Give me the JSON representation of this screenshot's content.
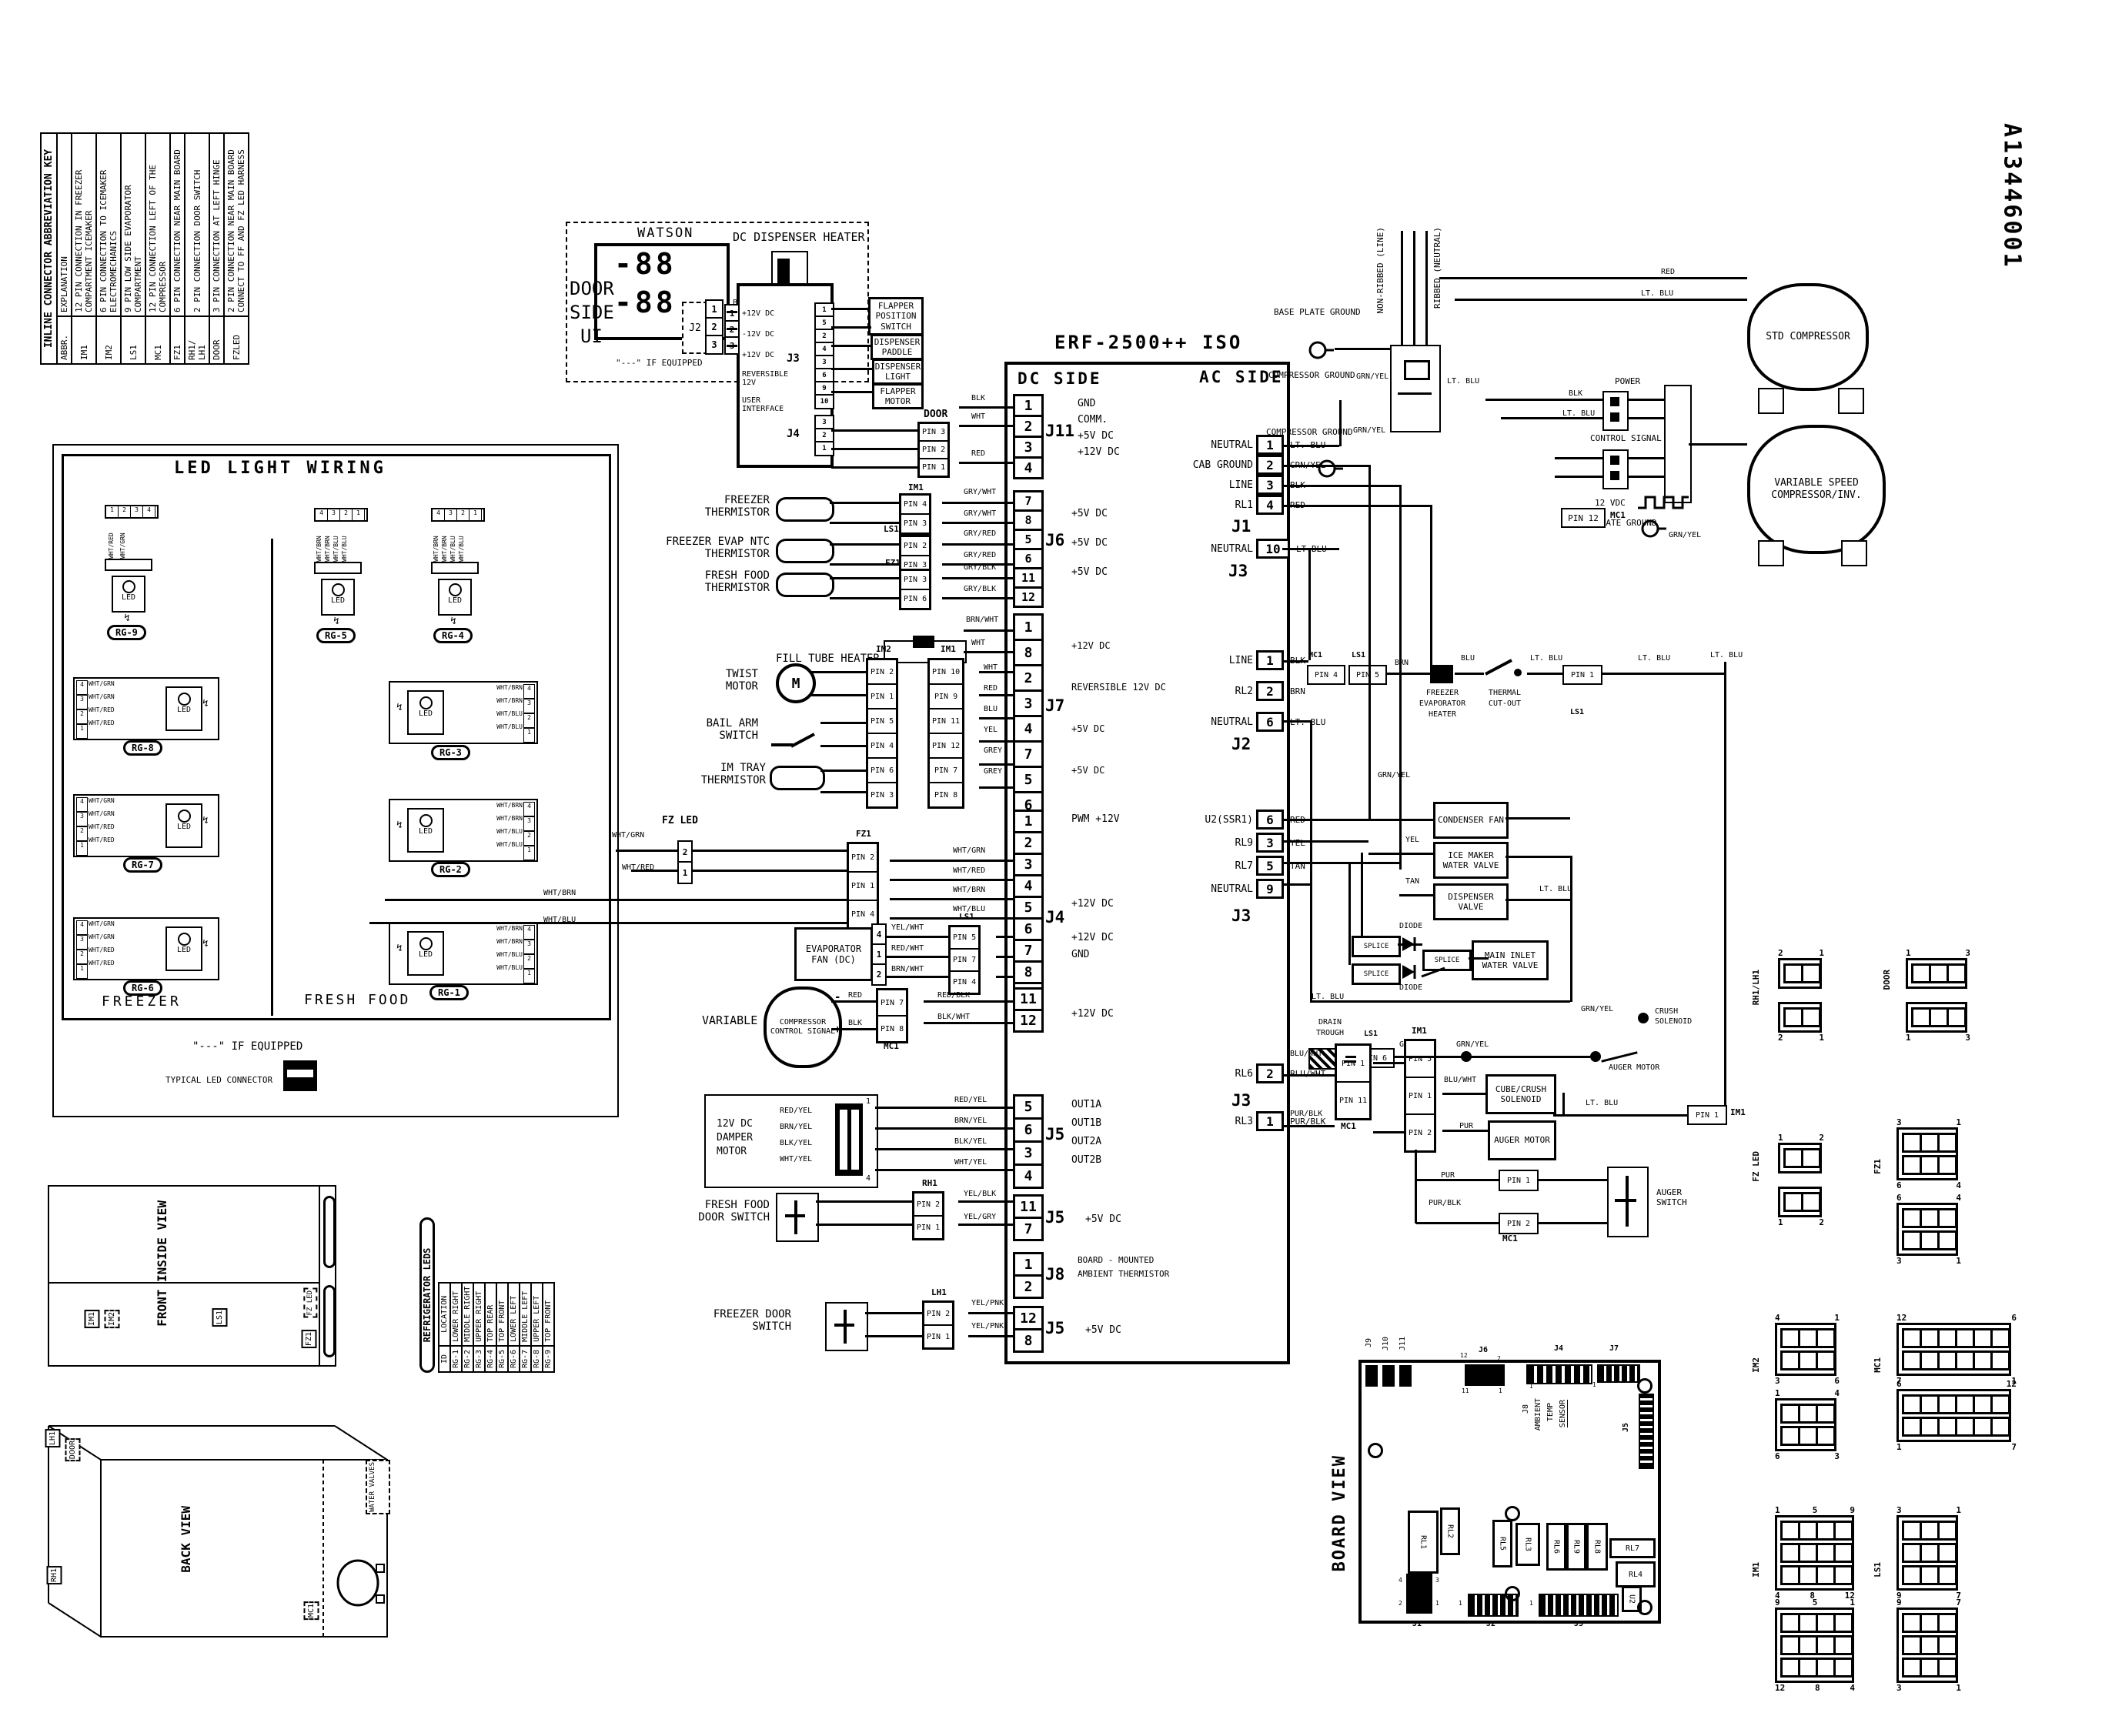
{
  "doc_number": "A13446001",
  "titles": {
    "board": "ERF-2500++ ISO",
    "dc": "DC SIDE",
    "ac": "AC SIDE",
    "led_box": "LED LIGHT WIRING",
    "freezer": "FREEZER",
    "fresh_food": "FRESH FOOD",
    "if_equipped": "\"---\" IF EQUIPPED",
    "typical_led": "TYPICAL LED CONNECTOR",
    "board_view": "BOARD VIEW",
    "front_view": "FRONT INSIDE VIEW",
    "back_view": "BACK VIEW"
  },
  "abbr_key": {
    "title": "INLINE CONNECTOR ABBREVIATION KEY",
    "headers": [
      "ABBR.",
      "EXPLANATION"
    ],
    "rows": [
      [
        "IM1",
        "12 PIN CONNECTION IN FREEZER COMPARTMENT ICEMAKER"
      ],
      [
        "IM2",
        "6 PIN CONNECTION TO ICEMAKER ELECTROMECHANICS"
      ],
      [
        "LS1",
        "9 PIN LOW SIDE EVAPORATOR COMPARTMENT"
      ],
      [
        "MC1",
        "12 PIN CONNECTION LEFT OF THE COMPRESSOR"
      ],
      [
        "FZ1",
        "6 PIN CONNECTION NEAR MAIN BOARD"
      ],
      [
        "RH1/ LH1",
        "2 PIN CONNECTION DOOR SWITCH"
      ],
      [
        "DOOR",
        "3 PIN CONNECTION AT LEFT HINGE"
      ],
      [
        "FZLED",
        "2 PIN CONNECTION NEAR MAIN BOARD CONNECT TO FF AND FZ LED HARNESS"
      ]
    ]
  },
  "led_table": {
    "title": "REFRIGERATOR LEDS",
    "headers": [
      "ID",
      "LOCATION"
    ],
    "rows": [
      [
        "RG-1",
        "LOWER RIGHT"
      ],
      [
        "RG-2",
        "MIDDLE RIGHT"
      ],
      [
        "RG-3",
        "UPPER RIGHT"
      ],
      [
        "RG-4",
        "TOP REAR"
      ],
      [
        "RG-5",
        "TOP FRONT"
      ],
      [
        "RG-6",
        "LOWER LEFT"
      ],
      [
        "RG-7",
        "MIDDLE LEFT"
      ],
      [
        "RG-8",
        "UPPER LEFT"
      ],
      [
        "RG-9",
        "TOP FRONT"
      ]
    ]
  },
  "led_glyph": {
    "led": "LED",
    "zap": "↯"
  },
  "led_groups": {
    "rg9": {
      "id": "RG-9",
      "pins": [
        "1",
        "2",
        "3",
        "4"
      ],
      "wires": [
        "WHT/RED",
        "WHT/GRN"
      ]
    },
    "rg5": {
      "id": "RG-5",
      "pins": [
        "4",
        "3",
        "2",
        "1"
      ],
      "wires": [
        "WHT/BRN",
        "WHT/BRN",
        "WHT/BLU",
        "WHT/BLU"
      ]
    },
    "rg4": {
      "id": "RG-4",
      "pins": [
        "4",
        "3",
        "2",
        "1"
      ],
      "wires": [
        "WHT/BRN",
        "WHT/BRN",
        "WHT/BLU",
        "WHT/BLU"
      ]
    },
    "rg8": {
      "id": "RG-8",
      "pins": [
        "4",
        "3",
        "2",
        "1"
      ],
      "wires": [
        "WHT/GRN",
        "WHT/GRN",
        "WHT/RED",
        "WHT/RED"
      ]
    },
    "rg3": {
      "id": "RG-3",
      "pins": [
        "4",
        "3",
        "2",
        "1"
      ],
      "wires": [
        "WHT/BRN",
        "WHT/BRN",
        "WHT/BLU",
        "WHT/BLU"
      ]
    },
    "rg7": {
      "id": "RG-7",
      "pins": [
        "4",
        "3",
        "2",
        "1"
      ],
      "wires": [
        "WHT/GRN",
        "WHT/GRN",
        "WHT/RED",
        "WHT/RED"
      ]
    },
    "rg2": {
      "id": "RG-2",
      "pins": [
        "4",
        "3",
        "2",
        "1"
      ],
      "wires": [
        "WHT/BRN",
        "WHT/BRN",
        "WHT/BLU",
        "WHT/BLU"
      ]
    },
    "rg6": {
      "id": "RG-6",
      "pins": [
        "4",
        "3",
        "2",
        "1"
      ],
      "wires": [
        "WHT/GRN",
        "WHT/GRN",
        "WHT/RED",
        "WHT/RED"
      ]
    },
    "rg1": {
      "id": "RG-1",
      "pins": [
        "4",
        "3",
        "2",
        "1"
      ],
      "wires": [
        "WHT/BRN",
        "WHT/BRN",
        "WHT/BLU",
        "WHT/BLU"
      ]
    }
  },
  "watson": {
    "title": "WATSON",
    "side1": "DOOR",
    "side2": "SIDE",
    "side3": "UI",
    "digits": [
      "-88",
      "-88"
    ],
    "conn": "J2",
    "pins": [
      "1",
      "2",
      "3"
    ],
    "wires": [
      "BLK",
      "WHT",
      "RED"
    ],
    "note": "\"---\" IF EQUIPPED"
  },
  "ui_board": {
    "heater": "DC DISPENSER HEATER",
    "heater_conn": "J7",
    "heater_pins": [
      "1",
      "2",
      "1",
      "2"
    ],
    "fn": [
      "+12V DC",
      "-12V DC",
      "+12V DC",
      "REVERSIBLE 12V",
      "USER INTERFACE"
    ],
    "j3": "J3",
    "j3_pins": [
      "1",
      "5",
      "2",
      "4",
      "3",
      "6",
      "9",
      "10"
    ],
    "j4": "J4",
    "j4_pins": [
      "3",
      "2",
      "1"
    ],
    "in_pins": [
      "1",
      "2",
      "3"
    ],
    "loads": [
      "FLAPPER POSITION SWITCH",
      "DISPENSER PADDLE",
      "DISPENSER LIGHT",
      "FLAPPER MOTOR"
    ]
  },
  "door_link": {
    "name": "DOOR",
    "pins": [
      "PIN 3",
      "PIN 2",
      "PIN 1"
    ],
    "wires": [
      "BLK",
      "WHT",
      "RED"
    ]
  },
  "main_dc": {
    "j11": {
      "name": "J11",
      "pins": [
        "1",
        "2",
        "3",
        "4"
      ],
      "fn": [
        "GND",
        "COMM.",
        "+5V DC",
        "+12V DC"
      ]
    },
    "j6": {
      "name": "J6",
      "pins": [
        "7",
        "8",
        "5",
        "6",
        "11",
        "12"
      ],
      "fn": [
        "",
        "+5V DC",
        "",
        "+5V DC",
        "",
        "+5V DC"
      ]
    },
    "j7": {
      "name": "J7",
      "pins": [
        "1",
        "8",
        "2",
        "3",
        "4",
        "7",
        "5",
        "6"
      ],
      "fn": [
        "",
        "+12V DC",
        "",
        "REVERSIBLE 12V DC",
        "",
        "+5V DC",
        "",
        "+5V DC"
      ]
    },
    "j4a": {
      "name": "J4",
      "pins": [
        "1",
        "2",
        "3",
        "4",
        "5",
        "6",
        "7",
        "8",
        "9"
      ],
      "fn": [
        "PWM +12V",
        "",
        "",
        "",
        "",
        "+12V DC",
        "",
        "+12V DC",
        "GND"
      ]
    },
    "j4b": {
      "pins": [
        "11",
        "12"
      ],
      "fn": [
        "",
        "+12V DC"
      ]
    },
    "j5a": {
      "name": "J5",
      "pins": [
        "5",
        "6",
        "3",
        "4"
      ],
      "fn": [
        "OUT1A",
        "OUT1B",
        "OUT2A",
        "OUT2B"
      ]
    },
    "j5b": {
      "name": "J5",
      "pins": [
        "11",
        "7"
      ],
      "fn": [
        "",
        "+5V DC"
      ]
    },
    "j8": {
      "name": "J8",
      "pins": [
        "1",
        "2"
      ],
      "note1": "BOARD - MOUNTED",
      "note2": "AMBIENT THERMISTOR"
    },
    "j5c": {
      "name": "J5",
      "pins": [
        "12",
        "8"
      ],
      "fn": [
        "",
        "+5V DC"
      ]
    }
  },
  "dc_parts": {
    "freezer_therm": {
      "l1": "FREEZER",
      "l2": "THERMISTOR",
      "conn": "IM1",
      "pins": [
        "PIN 4",
        "PIN 3"
      ],
      "w1": "GRY/WHT",
      "w2": "GRY/WHT"
    },
    "evap_therm": {
      "l1": "FREEZER EVAP NTC",
      "l2": "THERMISTOR",
      "conn": "LS1",
      "pins": [
        "PIN 2",
        "PIN 3"
      ],
      "w1": "GRY/RED",
      "w2": "GRY/RED"
    },
    "ff_therm": {
      "l1": "FRESH FOOD",
      "l2": "THERMISTOR",
      "conn": "FZ1",
      "pins": [
        "PIN 3",
        "PIN 6"
      ],
      "w1": "GRY/BLK",
      "w2": "GRY/BLK"
    },
    "fill_tube": {
      "label": "FILL TUBE HEATER",
      "w1": "BRN/WHT",
      "w2": "WHT"
    },
    "twist": {
      "l1": "TWIST",
      "l2": "MOTOR",
      "m": "M"
    },
    "bail": {
      "l1": "BAIL ARM",
      "l2": "SWITCH"
    },
    "im_tray": {
      "l1": "IM TRAY",
      "l2": "THERMISTOR"
    },
    "im2": {
      "name": "IM2",
      "pins": [
        "PIN 2",
        "PIN 1",
        "PIN 5",
        "PIN 4",
        "PIN 6",
        "PIN 3"
      ]
    },
    "im1": {
      "name": "IM1",
      "pins": [
        "PIN 10",
        "PIN 9",
        "PIN 11",
        "PIN 12",
        "PIN 7",
        "PIN 8"
      ],
      "wires": [
        "WHT",
        "RED",
        "BLU",
        "YEL",
        "GREY",
        "GREY"
      ]
    },
    "fzled": {
      "label": "FZ LED",
      "pins": [
        "2",
        "1"
      ],
      "w1": "WHT/GRN",
      "w2": "WHT/RED"
    },
    "fz1": {
      "name": "FZ1",
      "pins": [
        "PIN 2",
        "PIN 1",
        "PIN 4",
        "PIN 5"
      ],
      "wires": [
        "WHT/GRN",
        "WHT/RED",
        "WHT/BRN",
        "WHT/BLU"
      ]
    },
    "led_in1": "WHT/BRN",
    "led_in2": "WHT/BLU",
    "evap_fan": {
      "l1": "EVAPORATOR",
      "l2": "FAN (DC)",
      "pins": [
        "4",
        "1",
        "2"
      ],
      "wires": [
        "YEL/WHT",
        "RED/WHT",
        "BRN/WHT"
      ],
      "conn": "LS1",
      "cpins": [
        "PIN 5",
        "PIN 7",
        "PIN 4"
      ]
    },
    "var_sig": {
      "label": "VARIABLE",
      "inner": "COMPRESSOR CONTROL SIGNAL",
      "minus": "-",
      "plus": "+",
      "w1": "RED",
      "w2": "BLK",
      "conn": "MC1",
      "pins": [
        "PIN 7",
        "PIN 8"
      ],
      "o1": "RED/BLK",
      "o2": "BLK/WHT"
    },
    "damper": {
      "l1": "12V DC",
      "l2": "DAMPER",
      "l3": "MOTOR",
      "wires": [
        "RED/YEL",
        "BRN/YEL",
        "BLK/YEL",
        "WHT/YEL"
      ],
      "out": [
        "RED/YEL",
        "BRN/YEL",
        "BLK/YEL",
        "WHT/YEL"
      ],
      "p1": "1",
      "p4": "4"
    },
    "ff_door": {
      "l1": "FRESH FOOD",
      "l2": "DOOR SWITCH",
      "conn": "RH1",
      "pins": [
        "PIN 2",
        "PIN 1"
      ],
      "w1": "YEL/BLK",
      "w2": "YEL/GRY"
    },
    "fz_door": {
      "l1": "FREEZER DOOR",
      "l2": "SWITCH",
      "conn": "LH1",
      "pins": [
        "PIN 2",
        "PIN 1"
      ],
      "w1": "YEL/PNK",
      "w2": "YEL/PNK"
    }
  },
  "ac": {
    "j1": {
      "name": "J1",
      "rows": [
        {
          "f": "NEUTRAL",
          "n": "1",
          "w": "LT. BLU"
        },
        {
          "f": "CAB GROUND",
          "n": "2",
          "w": "GRN/YEL"
        },
        {
          "f": "LINE",
          "n": "3",
          "w": "BLK"
        },
        {
          "f": "RL1",
          "n": "4",
          "w": "RED"
        }
      ]
    },
    "j3top": {
      "name": "J3",
      "rows": [
        {
          "f": "NEUTRAL",
          "n": "10",
          "w": "LT.BLU"
        }
      ]
    },
    "j2": {
      "name": "J2",
      "rows": [
        {
          "f": "LINE",
          "n": "1",
          "w": "BLK"
        },
        {
          "f": "RL2",
          "n": "2",
          "w": "BRN"
        },
        {
          "f": "NEUTRAL",
          "n": "6",
          "w": "LT. BLU"
        }
      ]
    },
    "j3mid": {
      "name": "J3",
      "rows": [
        {
          "f": "U2(SSR1)",
          "n": "6",
          "w": "RED"
        },
        {
          "f": "RL9",
          "n": "3",
          "w": "YEL"
        },
        {
          "f": "RL7",
          "n": "5",
          "w": "TAN"
        },
        {
          "f": "NEUTRAL",
          "n": "9",
          "w": ""
        }
      ]
    },
    "j3bot": {
      "name": "J3",
      "rows": [
        {
          "f": "RL6",
          "n": "2",
          "w": "BLU/WHT"
        },
        {
          "f": "RL3",
          "n": "1",
          "w": "PUR/BLK"
        }
      ]
    },
    "comp_ground": "COMPRESSOR GROUND",
    "base_plate": "BASE PLATE GROUND",
    "line_cord": "NON-RIBBED (LINE)",
    "neutral_cord": "RIBBED (NEUTRAL)",
    "grn_yel": "GRN/YEL",
    "lt_blu": "LT. BLU",
    "std_comp": "STD COMPRESSOR",
    "std_w1": "RED",
    "std_w2": "LT. BLU",
    "var_comp": "VARIABLE SPEED COMPRESSOR/INV.",
    "power": "POWER",
    "pw1": "BLK",
    "pw2": "LT. BLU",
    "control": "CONTROL SIGNAL",
    "vdc": "12 VDC",
    "pin12": "PIN 12",
    "pin12_conn": "MC1",
    "chain": {
      "mc1": "MC1",
      "p4": "PIN 4",
      "ls1": "LS1",
      "p5": "PIN 5",
      "brn": "BRN",
      "h1": "FREEZER",
      "h2": "EVAPORATOR",
      "h3": "HEATER",
      "blu": "BLU",
      "t1": "THERMAL",
      "t2": "CUT-OUT",
      "ltblu": "LT. BLU",
      "p1": "PIN 1",
      "ls1b": "LS1",
      "ltblu2": "LT. BLU",
      "ltblu3": "LT. BLU"
    },
    "condenser": "CONDENSER FAN",
    "icemaker": "ICE MAKER WATER VALVE",
    "ice_w": "YEL",
    "dispvalve": "DISPENSER VALVE",
    "disp_w": "TAN",
    "splice": "SPLICE",
    "diode": "DIODE",
    "main_inlet": "MAIN INLET WATER VALVE",
    "drain": {
      "l1": "DRAIN",
      "l2": "TROUGH",
      "conn": "LS1",
      "pin": "PIN 6",
      "w": "GRN/YEL"
    },
    "mc1_blk": {
      "name": "MC1",
      "pins": [
        "PIN 1",
        "PIN 11"
      ]
    },
    "im1_blk": {
      "name": "IM1",
      "pins": [
        "PIN 5",
        "PIN 1",
        "PIN 2"
      ],
      "w1": "GRN/YEL",
      "w2": "BLU/WHT",
      "w3": "PUR"
    },
    "cube": "CUBE/CRUSH SOLENOID",
    "auger_motor": "AUGER MOTOR",
    "crush": "CRUSH SOLENOID",
    "crush_w": "GRN/YEL",
    "ret": {
      "w": "LT. BLU",
      "pin": "PIN 1",
      "conn": "IM1"
    },
    "mc1_low": {
      "name": "MC1",
      "p1": "PIN 1",
      "p2": "PIN 2",
      "w1": "PUR",
      "w2": "PUR/BLK"
    },
    "auger_switch": "AUGER SWITCH"
  },
  "board_view": {
    "label": "BOARD VIEW",
    "j9": "J9",
    "j10": "J10",
    "j11": "J11",
    "j6": "J6",
    "j6_n": [
      "12",
      "2",
      "11",
      "1"
    ],
    "j4": "J4",
    "j7": "J7",
    "j5": "J5",
    "j8_note": [
      "J8",
      "AMBIENT",
      "TEMP",
      "SENSOR"
    ],
    "j1": "J1",
    "j2": "J2",
    "j3": "J3",
    "one": "1",
    "j1_n": [
      "4",
      "2",
      "3",
      "1"
    ],
    "relays": [
      "RL1",
      "RL2",
      "RL5",
      "RL3",
      "RL6",
      "RL9",
      "RL8"
    ],
    "rl7": "RL7",
    "rl4": "RL4",
    "u2": "U2"
  },
  "pinouts": [
    {
      "name": "RH1/LH1",
      "cols": 2,
      "cells": [
        "",
        ""
      ],
      "f1t": [
        "2",
        "1"
      ],
      "f1b": [],
      "f2t": [],
      "f2b": [
        "2",
        "1"
      ]
    },
    {
      "name": "DOOR",
      "cols": 3,
      "cells": [
        "",
        "",
        ""
      ],
      "f1t": [
        "1",
        "3"
      ],
      "f1b": [],
      "f2t": [],
      "f2b": [
        "1",
        "3"
      ]
    },
    {
      "name": "FZ LED",
      "cols": 2,
      "cells": [
        "",
        ""
      ],
      "f1t": [
        "1",
        "2"
      ],
      "f1b": [],
      "f2t": [],
      "f2b": [
        "1",
        "2"
      ]
    },
    {
      "name": "FZ1",
      "cols": 3,
      "cells": [
        "",
        "",
        "",
        "",
        "",
        ""
      ],
      "f1t": [
        "3",
        "1"
      ],
      "f1b": [
        "6",
        "4"
      ],
      "f2t": [
        "6",
        "4"
      ],
      "f2b": [
        "3",
        "1"
      ]
    },
    {
      "name": "IM2",
      "cols": 3,
      "cells": [
        "",
        "",
        "",
        "",
        "",
        ""
      ],
      "f1t": [
        "4",
        "1"
      ],
      "f1b": [
        "3",
        "6"
      ],
      "f2t": [
        "1",
        "4"
      ],
      "f2b": [
        "6",
        "3"
      ]
    },
    {
      "name": "MC1",
      "cols": 6,
      "cells": [
        "",
        "",
        "",
        "",
        "",
        "",
        "",
        "",
        "",
        "",
        "",
        ""
      ],
      "f1t": [
        "12",
        "6"
      ],
      "f1b": [
        "7",
        "1"
      ],
      "f2t": [
        "6",
        "12"
      ],
      "f2b": [
        "1",
        "7"
      ]
    },
    {
      "name": "IM1",
      "cols": 4,
      "cells": [
        "",
        "",
        "",
        "",
        "",
        "",
        "",
        "",
        "",
        "",
        "",
        ""
      ],
      "f1t": [
        "1",
        "5",
        "9"
      ],
      "f1b": [
        "4",
        "8",
        "12"
      ],
      "f2t": [
        "9",
        "5",
        "1"
      ],
      "f2b": [
        "12",
        "8",
        "4"
      ]
    },
    {
      "name": "LS1",
      "cols": 3,
      "cells": [
        "",
        "",
        "",
        "",
        "",
        "",
        "",
        "",
        ""
      ],
      "f1t": [
        "3",
        "1"
      ],
      "f1b": [
        "9",
        "7"
      ],
      "f2t": [
        "9",
        "7"
      ],
      "f2b": [
        "3",
        "1"
      ]
    }
  ],
  "views": {
    "front": {
      "title": "FRONT INSIDE VIEW",
      "im1": "IM1",
      "im2": "IM2",
      "ls1": "LS1",
      "fzled": "FZ LED",
      "fz1": "FZ1"
    },
    "back": {
      "title": "BACK VIEW",
      "lh1": "LH1",
      "door": "DOOR",
      "rh1": "RH1",
      "mc1": "MC1",
      "wv": "WATER VALVES"
    }
  }
}
